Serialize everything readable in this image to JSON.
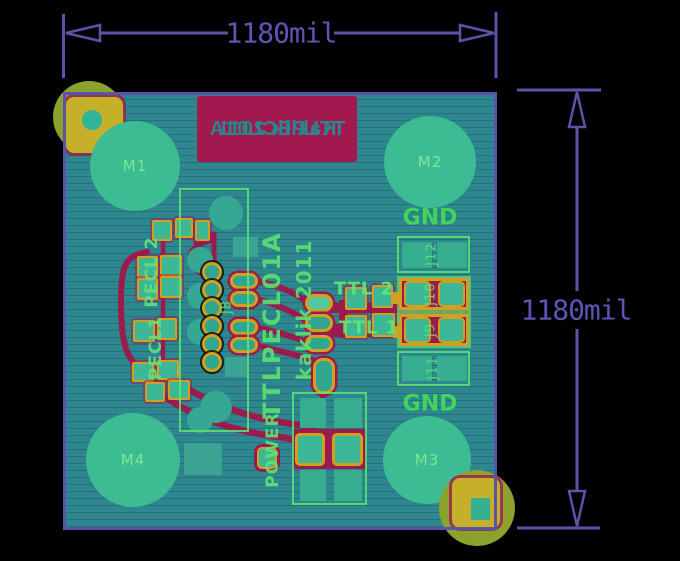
{
  "view": {
    "description": "PCB layout render, bottom copper view"
  },
  "dimensions": {
    "horizontal": {
      "label": "1180mil"
    },
    "vertical": {
      "label": "1180mil"
    }
  },
  "board": {
    "stamp": {
      "line1": "TTLPECL01A",
      "line2": "Kaklik 2011",
      "mirrored": true
    },
    "mount_holes": {
      "m1": "M1",
      "m2": "M2",
      "m3": "M3",
      "m4": "M4"
    },
    "nets": {
      "gnd_top": "GND",
      "gnd_bottom": "GND"
    },
    "refdes": {
      "j8": "J8",
      "j9": "J9",
      "j10": "J10",
      "j11": "J11",
      "j12": "J12",
      "power": "POWER",
      "pecl1": "PECL1",
      "pecl2": "PECL 2",
      "ttl1": "TTL 1",
      "ttl2": "TTL 2"
    },
    "silkscreen": {
      "title": "TTLPECL01A",
      "author": "kaklik 2011"
    }
  },
  "colors": {
    "background": "#000000",
    "dimension_purple": "#5a53aa",
    "board_teal": "#2e868f",
    "copper_trace_maroon": "#9c1b4f",
    "pad_gold": "#d2a021",
    "silkscreen_green": "#5fe36f",
    "hole_green": "#3dbb92",
    "fiducial_yellow": "#c6b02a",
    "fiducial_olive": "#8ba32e",
    "stamp_maroon": "#a2194f"
  }
}
